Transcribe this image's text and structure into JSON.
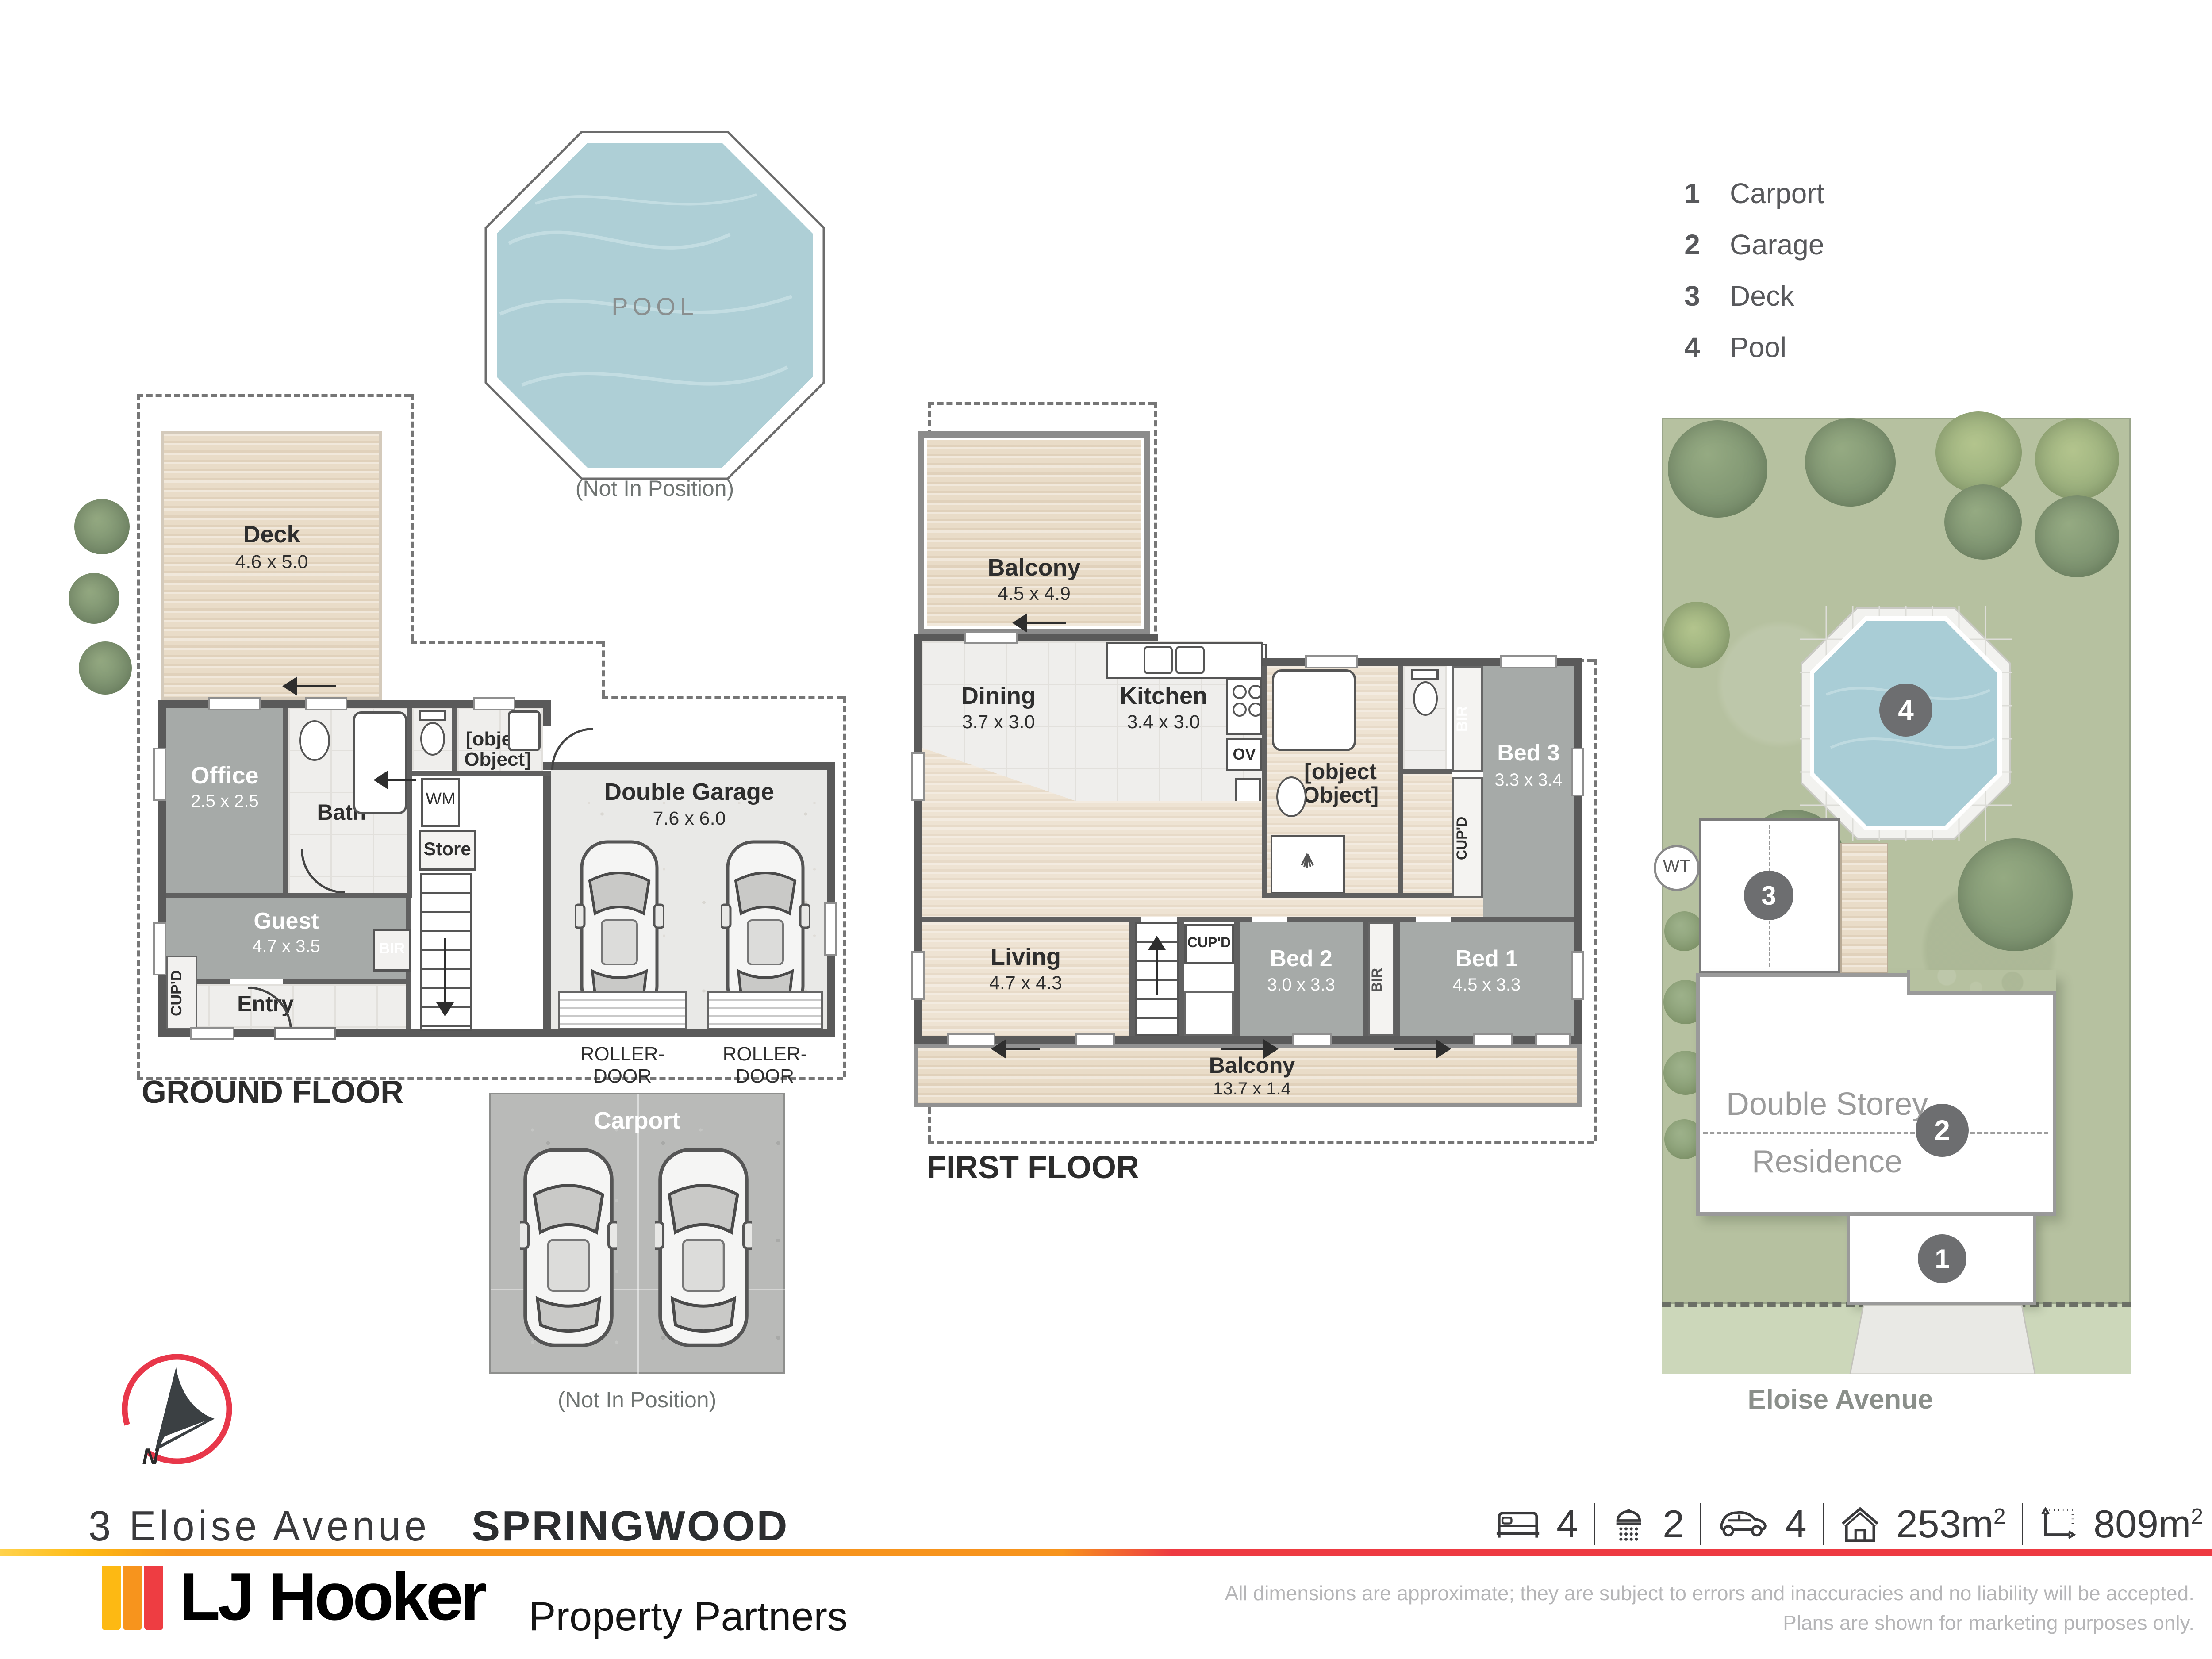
{
  "legend": {
    "items": [
      {
        "num": "1",
        "label": "Carport"
      },
      {
        "num": "2",
        "label": "Garage"
      },
      {
        "num": "3",
        "label": "Deck"
      },
      {
        "num": "4",
        "label": "Pool"
      }
    ]
  },
  "pool_plan": {
    "label": "POOL",
    "note": "(Not In Position)"
  },
  "ground_floor": {
    "title": "GROUND FLOOR",
    "deck": {
      "name": "Deck",
      "dims": "4.6 x 5.0"
    },
    "office": {
      "name": "Office",
      "dims": "2.5 x 2.5"
    },
    "bath": {
      "name": "Bath"
    },
    "ldry": {
      "name": "L'dry"
    },
    "wm": "WM",
    "store": "Store",
    "bir": "BIR",
    "cupd": "CUP'D",
    "guest": {
      "name": "Guest",
      "dims": "4.7 x 3.5"
    },
    "entry": {
      "name": "Entry"
    },
    "garage": {
      "name": "Double Garage",
      "dims": "7.6 x 6.0"
    },
    "roller_door": "ROLLER-DOOR"
  },
  "carport_plan": {
    "label": "Carport",
    "note": "(Not In Position)"
  },
  "first_floor": {
    "title": "FIRST FLOOR",
    "balcony_top": {
      "name": "Balcony",
      "dims": "4.5 x 4.9"
    },
    "dining": {
      "name": "Dining",
      "dims": "3.7 x 3.0"
    },
    "kitchen": {
      "name": "Kitchen",
      "dims": "3.4 x 3.0"
    },
    "bath": {
      "name": "Bath"
    },
    "bed3": {
      "name": "Bed 3",
      "dims": "3.3 x 3.4"
    },
    "living": {
      "name": "Living",
      "dims": "4.7 x 4.3"
    },
    "bed2": {
      "name": "Bed 2",
      "dims": "3.0 x 3.3"
    },
    "bed1": {
      "name": "Bed 1",
      "dims": "4.5 x 3.3"
    },
    "balcony_bottom": {
      "name": "Balcony",
      "dims": "13.7 x 1.4"
    },
    "ptry": "P'TRY",
    "ov": "OV",
    "bir": "BIR",
    "cupd": "CUP'D"
  },
  "site": {
    "residence_line1": "Double Storey",
    "residence_line2": "Residence",
    "street": "Eloise Avenue",
    "wt": "WT",
    "markers": {
      "carport": "1",
      "garage": "2",
      "deck": "3",
      "pool": "4"
    }
  },
  "compass": {
    "north": "N"
  },
  "footer": {
    "address_street": "3 Eloise Avenue",
    "address_suburb": "SPRINGWOOD",
    "stats": [
      {
        "icon": "bed-icon",
        "value": "4",
        "sup": ""
      },
      {
        "icon": "shower-icon",
        "value": "2",
        "sup": ""
      },
      {
        "icon": "car-icon",
        "value": "4",
        "sup": ""
      },
      {
        "icon": "house-icon",
        "value": "253m",
        "sup": "2"
      },
      {
        "icon": "land-icon",
        "value": "809m",
        "sup": "2"
      }
    ],
    "brand": "LJ Hooker",
    "brand_sub": "Property Partners",
    "disclaimer_line1": "All dimensions are approximate; they are subject to errors and inaccuracies and no liability will be accepted.",
    "disclaimer_line2": "Plans are shown for marketing purposes only."
  },
  "colors": {
    "accent_yellow": "#fdb913",
    "accent_orange": "#f7941d",
    "accent_red": "#ee3d42",
    "compass_red": "#e8374a",
    "room_gray": "#a6aaa8",
    "pool_blue": "#aecfd6",
    "grass_green": "#b6c1a0",
    "wall_gray": "#5a5a5a",
    "marker_gray": "#6d6e70"
  }
}
